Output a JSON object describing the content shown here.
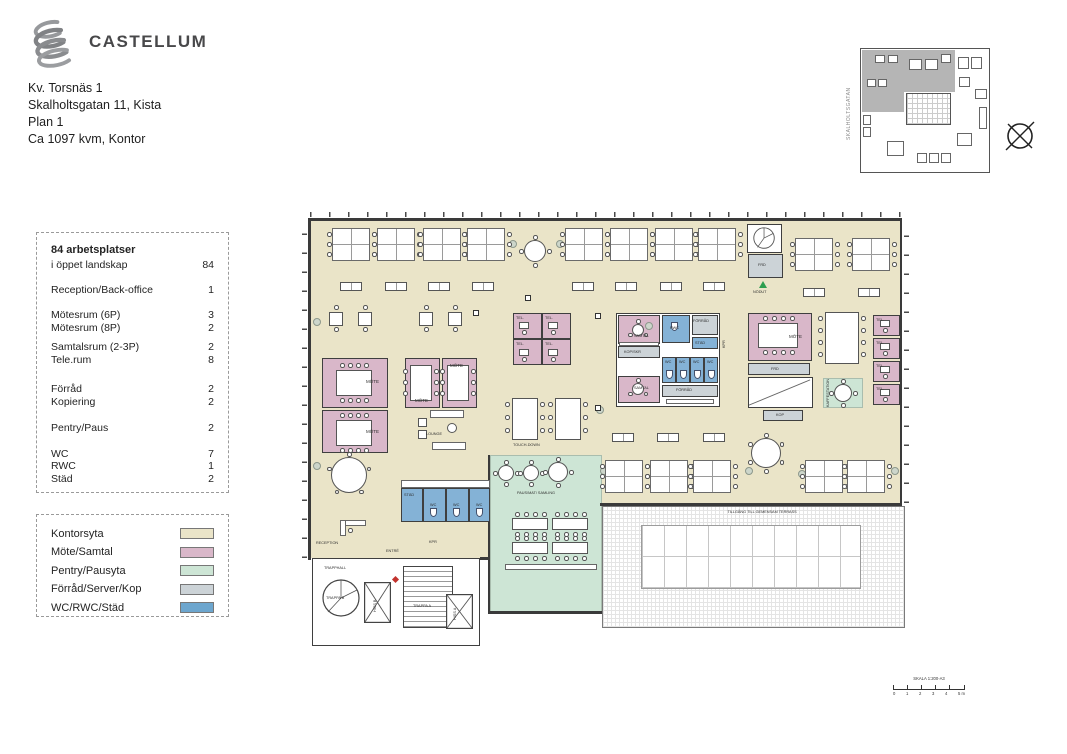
{
  "header": {
    "brand": "CASTELLUM",
    "address_line1": "Kv. Torsnäs 1",
    "address_line2": "Skalholtsgatan 11, Kista",
    "address_line3": "Plan 1",
    "address_line4": "Ca 1097 kvm, Kontor"
  },
  "stats": {
    "title": "84 arbetsplatser",
    "rows": [
      {
        "label": "i öppet landskap",
        "value": "84"
      },
      {
        "label": "Reception/Back-office",
        "value": "1"
      },
      {
        "label": "Mötesrum (6P)",
        "value": "3"
      },
      {
        "label": "Mötesrum (8P)",
        "value": "2"
      },
      {
        "label": "Samtalsrum (2-3P)",
        "value": "2"
      },
      {
        "label": "Tele.rum",
        "value": "8"
      },
      {
        "label": "Förråd",
        "value": "2"
      },
      {
        "label": "Kopiering",
        "value": "2"
      },
      {
        "label": "Pentry/Paus",
        "value": "2"
      },
      {
        "label": "WC",
        "value": "7"
      },
      {
        "label": "RWC",
        "value": "1"
      },
      {
        "label": "Städ",
        "value": "2"
      }
    ]
  },
  "legend": {
    "items": [
      {
        "label": "Kontorsyta",
        "color": "#eae4c8"
      },
      {
        "label": "Möte/Samtal",
        "color": "#d9b7c9"
      },
      {
        "label": "Pentry/Pausyta",
        "color": "#cde5d5"
      },
      {
        "label": "Förråd/Server/Kop",
        "color": "#ccd3d7"
      },
      {
        "label": "WC/RWC/Städ",
        "color": "#6da6ce"
      }
    ]
  },
  "minimap": {
    "street": "SKALHOLTSGATAN"
  },
  "scalebar": {
    "title": "SKALA 1:200-A3",
    "tick_labels": [
      "0",
      "1",
      "2",
      "3",
      "4",
      "5 m"
    ]
  },
  "plan": {
    "labels": {
      "mote": "MÖTE",
      "tel": "TEL.",
      "samtal": "SAMTAL",
      "kop_skr": "KOP/SKR",
      "rwc": "RWC",
      "stad": "STÄD",
      "forrad": "FÖRRÅD",
      "wc": "WC",
      "frd": "FRD",
      "kop": "KOP",
      "nodut": "NÖDUT",
      "lounge": "LOUNGE",
      "touch_down": "TOUCH-DOWN",
      "reception": "RECEPTION",
      "entre": "ENTRÉ",
      "trapphall": "TRAPPHALL",
      "trappa_a": "TRAPPA A",
      "trappa_b": "TRAPPA B",
      "hiss_a": "HISS A",
      "hiss_b": "HISS B",
      "kpr": "KPR",
      "kaffestation": "KAFFESTATION",
      "paus": "PAUS/MAT/ SAMLING",
      "terrass": "TILLGÅNG TILL GEMENSAM TERRASS"
    }
  }
}
